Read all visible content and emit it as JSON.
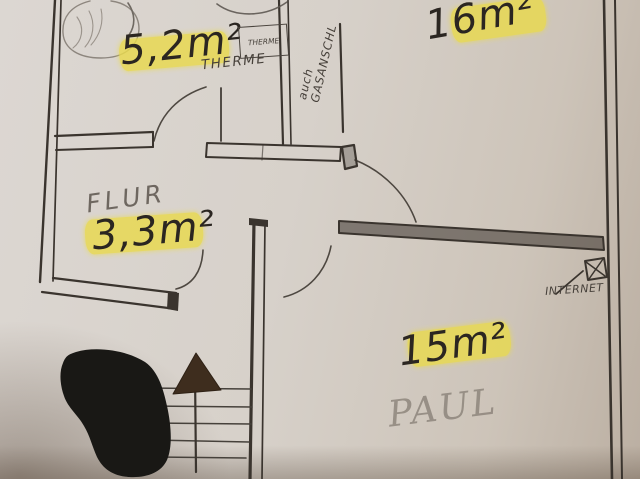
{
  "colors": {
    "paper": "#d6d0c9",
    "ink": "#3a342e",
    "pencil": "#6e6760",
    "highlight": "#e9da4e",
    "blob": "#191815",
    "arrowhead": "#3e2d1e"
  },
  "rooms": {
    "bathroom": {
      "area": "5,2m²"
    },
    "room_top_right": {
      "area": "16m²"
    },
    "hallway": {
      "name": "FLUR",
      "area": "3,3m²"
    },
    "room_bottom_right": {
      "area": "15m²",
      "note": "PAUL"
    }
  },
  "annotations": {
    "therme_box": "THERME",
    "therme": "THERME",
    "gas_line1": "auch",
    "gas_line2": "GASANSCHL",
    "internet": "INTERNET"
  }
}
